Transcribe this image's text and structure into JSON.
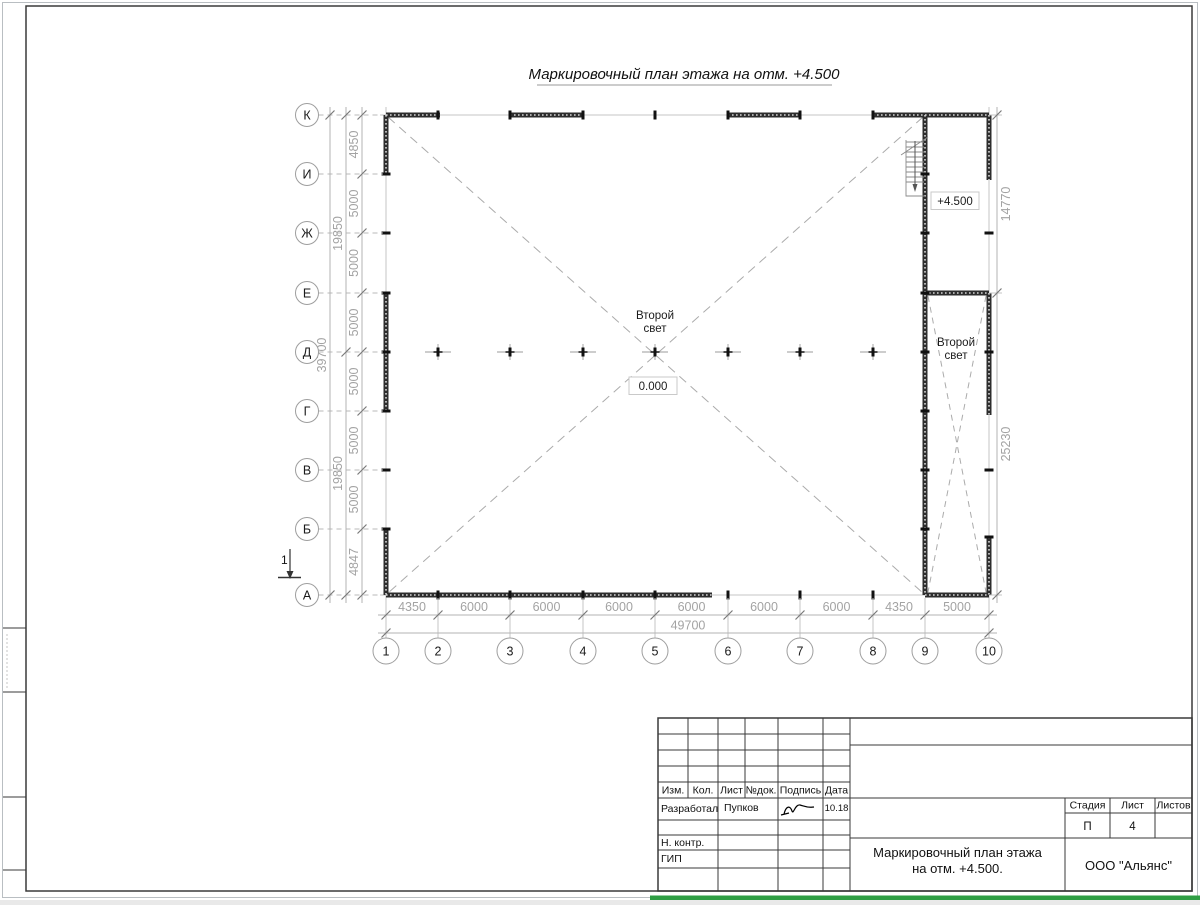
{
  "sheet": {
    "title": "Маркировочный план этажа на отм. +4.500",
    "bottom_bar_color": "#2f9e44"
  },
  "plan": {
    "row_axes": [
      "К",
      "И",
      "Ж",
      "Е",
      "Д",
      "Г",
      "В",
      "Б",
      "А"
    ],
    "col_axes": [
      "1",
      "2",
      "3",
      "4",
      "5",
      "6",
      "7",
      "8",
      "9",
      "10"
    ],
    "dims_bottom": [
      "4350",
      "6000",
      "6000",
      "6000",
      "6000",
      "6000",
      "6000",
      "4350",
      "5000"
    ],
    "dim_bottom_total": "49700",
    "dims_left": [
      "4850",
      "5000",
      "5000",
      "5000",
      "5000",
      "5000",
      "5000",
      "4847"
    ],
    "dims_left_mid": [
      "19850",
      "19850"
    ],
    "dim_left_total": "39700",
    "dims_right": [
      "14770",
      "25230"
    ],
    "labels": {
      "second_light_l1": "Второй",
      "second_light_l2": "свет",
      "elev_zero": "0.000",
      "elev_plus": "+4.500",
      "section_mark": "1"
    }
  },
  "titleblock": {
    "columns": [
      "Изм.",
      "Кол.",
      "Лист",
      "№док.",
      "Подпись",
      "Дата"
    ],
    "developed_by_label": "Разработал",
    "developed_by_name": "Пупков",
    "date": "10.18",
    "n_contr_label": "Н. контр.",
    "gip_label": "ГИП",
    "doc_title_l1": "Маркировочный план этажа",
    "doc_title_l2": "на отм. +4.500.",
    "company": "ООО \"Альянс\"",
    "stage_label": "Стадия",
    "sheet_label": "Лист",
    "sheets_label": "Листов",
    "stage_value": "П",
    "sheet_value": "4"
  }
}
